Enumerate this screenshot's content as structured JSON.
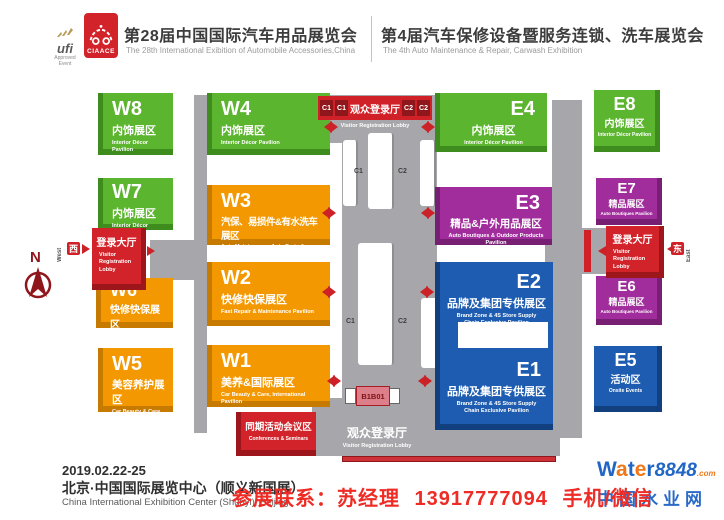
{
  "header": {
    "ufi_label": "ufi",
    "ufi_sub": "Approved Event",
    "logo_text": "CIAACE",
    "expo1_zh": "第28届中国国际汽车用品展览会",
    "expo1_en": "The 28th International Exibition of Automobile Accessories,China",
    "expo2_zh": "第4届汽车保修设备暨服务连锁、洗车展览会",
    "expo2_en": "The 4th Auto Maintenance & Repair, Carwash Exhibition"
  },
  "map": {
    "halls": [
      {
        "code": "W8",
        "zh": "内饰展区",
        "en": "Interior Décor Pavilion",
        "color": "green"
      },
      {
        "code": "W7",
        "zh": "内饰展区",
        "en": "Interior Décor Pavilion",
        "color": "green"
      },
      {
        "code": "W6",
        "zh": "快修快保展区",
        "en": "Fast Repair & Maintenance Pavilion",
        "color": "orange"
      },
      {
        "code": "W5",
        "zh": "美容养护展区",
        "en": "Car Beauty & Care Pavilion",
        "color": "orange"
      },
      {
        "code": "W4",
        "zh": "内饰展区",
        "en": "Interior Décor Pavilion",
        "color": "green"
      },
      {
        "code": "W3",
        "zh": "汽保、易损件&有水洗车展区",
        "en": "Auto Maintenance, Auto Parts & Carwash Pavilion",
        "color": "orange"
      },
      {
        "code": "W2",
        "zh": "快修快保展区",
        "en": "Fast Repair & Maintenance Pavilion",
        "color": "orange"
      },
      {
        "code": "W1",
        "zh": "美养&国际展区",
        "en": "Car Beauty & Care, International Pavilion",
        "color": "orange"
      },
      {
        "code": "E4",
        "zh": "内饰展区",
        "en": "Interior Décor Pavilion",
        "color": "green"
      },
      {
        "code": "E3",
        "zh": "精品&户外用品展区",
        "en": "Auto Boutiques & Outdoor Products Pavilion",
        "color": "purple"
      },
      {
        "code": "E2",
        "zh": "品牌及集团专供展区",
        "en": "Brand Zone & 4S Store Supply Chain Exclusive Pavilion",
        "color": "blue"
      },
      {
        "code": "E1",
        "zh": "品牌及集团专供展区",
        "en": "Brand Zone & 4S Store Supply Chain Exclusive Pavilion",
        "color": "blue"
      },
      {
        "code": "E8",
        "zh": "内饰展区",
        "en": "Interior Décor Pavilion",
        "color": "green"
      },
      {
        "code": "E7",
        "zh": "精品展区",
        "en": "Auto Boutiques Pavilion",
        "color": "purple"
      },
      {
        "code": "E6",
        "zh": "精品展区",
        "en": "Auto Boutiques Pavilion",
        "color": "purple"
      },
      {
        "code": "E5",
        "zh": "活动区",
        "en": "Onsite Events",
        "color": "blue"
      }
    ],
    "west_lobby": {
      "zh": "登录大厅",
      "en": "Visitor Registration Lobby"
    },
    "east_lobby": {
      "zh": "登录大厅",
      "en": "Visitor Registration Lobby"
    },
    "top_lobby": {
      "zh": "观众登录厅",
      "en": "Visitor Registration Lobby"
    },
    "bottom_lobby": {
      "zh": "观众登录厅",
      "en": "Visitor Registration Lobby"
    },
    "conference": {
      "zh": "同期活动会议区",
      "en": "Conferences & Seminars"
    },
    "corridor": {
      "c_top": [
        "C1",
        "C1",
        "C2",
        "C2"
      ],
      "c_mid_left": "C1",
      "c_mid_right": "C2",
      "c_low_left": "C1",
      "c_low_right": "C2",
      "booth": "B1B01"
    },
    "compass": "N",
    "west": {
      "zh": "西",
      "en": "West"
    },
    "east": {
      "zh": "东",
      "en": "East"
    }
  },
  "footer": {
    "date": "2019.02.22-25",
    "venue_zh": "北京·中国国际展览中心（顺义新国展）",
    "venue_en": "China International Exhibition Center (Shunyi), Beijing",
    "contact": "参展联系：苏经理 13917777094 手机/微信",
    "watermark": {
      "w": "W",
      "a": "a",
      "t": "t",
      "e": "e",
      "r": "r",
      "num": "8848",
      "dotcom": ".com",
      "zh": "中国水业网"
    }
  },
  "colors": {
    "green": "#5cb52f",
    "orange": "#f39800",
    "purple": "#a02d9b",
    "blue": "#1d5cb0",
    "red": "#d2232a",
    "dark_red": "#9c161b",
    "gray": "#a7a7ab",
    "arrow_red": "#cc2127",
    "contact_red": "#ee2b24",
    "watermark_blue": "#2166c4",
    "watermark_orange": "#f07818"
  }
}
